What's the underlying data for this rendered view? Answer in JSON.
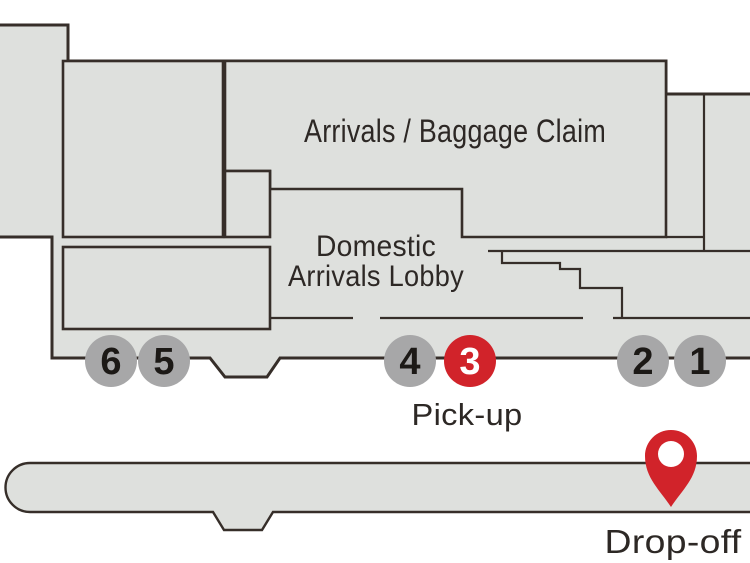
{
  "colors": {
    "building_fill": "#dee0dd",
    "outline": "#362e29",
    "stop_fill": "#a7a7a8",
    "stop_digit": "#1c1916",
    "accent": "#d1232a",
    "label_text": "#2d2825",
    "white": "#ffffff"
  },
  "areas": {
    "baggage_claim": "Arrivals / Baggage Claim",
    "lobby_line1": "Domestic",
    "lobby_line2": "Arrivals Lobby"
  },
  "markers": {
    "pickup": "Pick-up",
    "dropoff": "Drop-off"
  },
  "stops": [
    {
      "number": "6",
      "highlight": false
    },
    {
      "number": "5",
      "highlight": false
    },
    {
      "number": "4",
      "highlight": false
    },
    {
      "number": "3",
      "highlight": true
    },
    {
      "number": "2",
      "highlight": false
    },
    {
      "number": "1",
      "highlight": false
    }
  ]
}
